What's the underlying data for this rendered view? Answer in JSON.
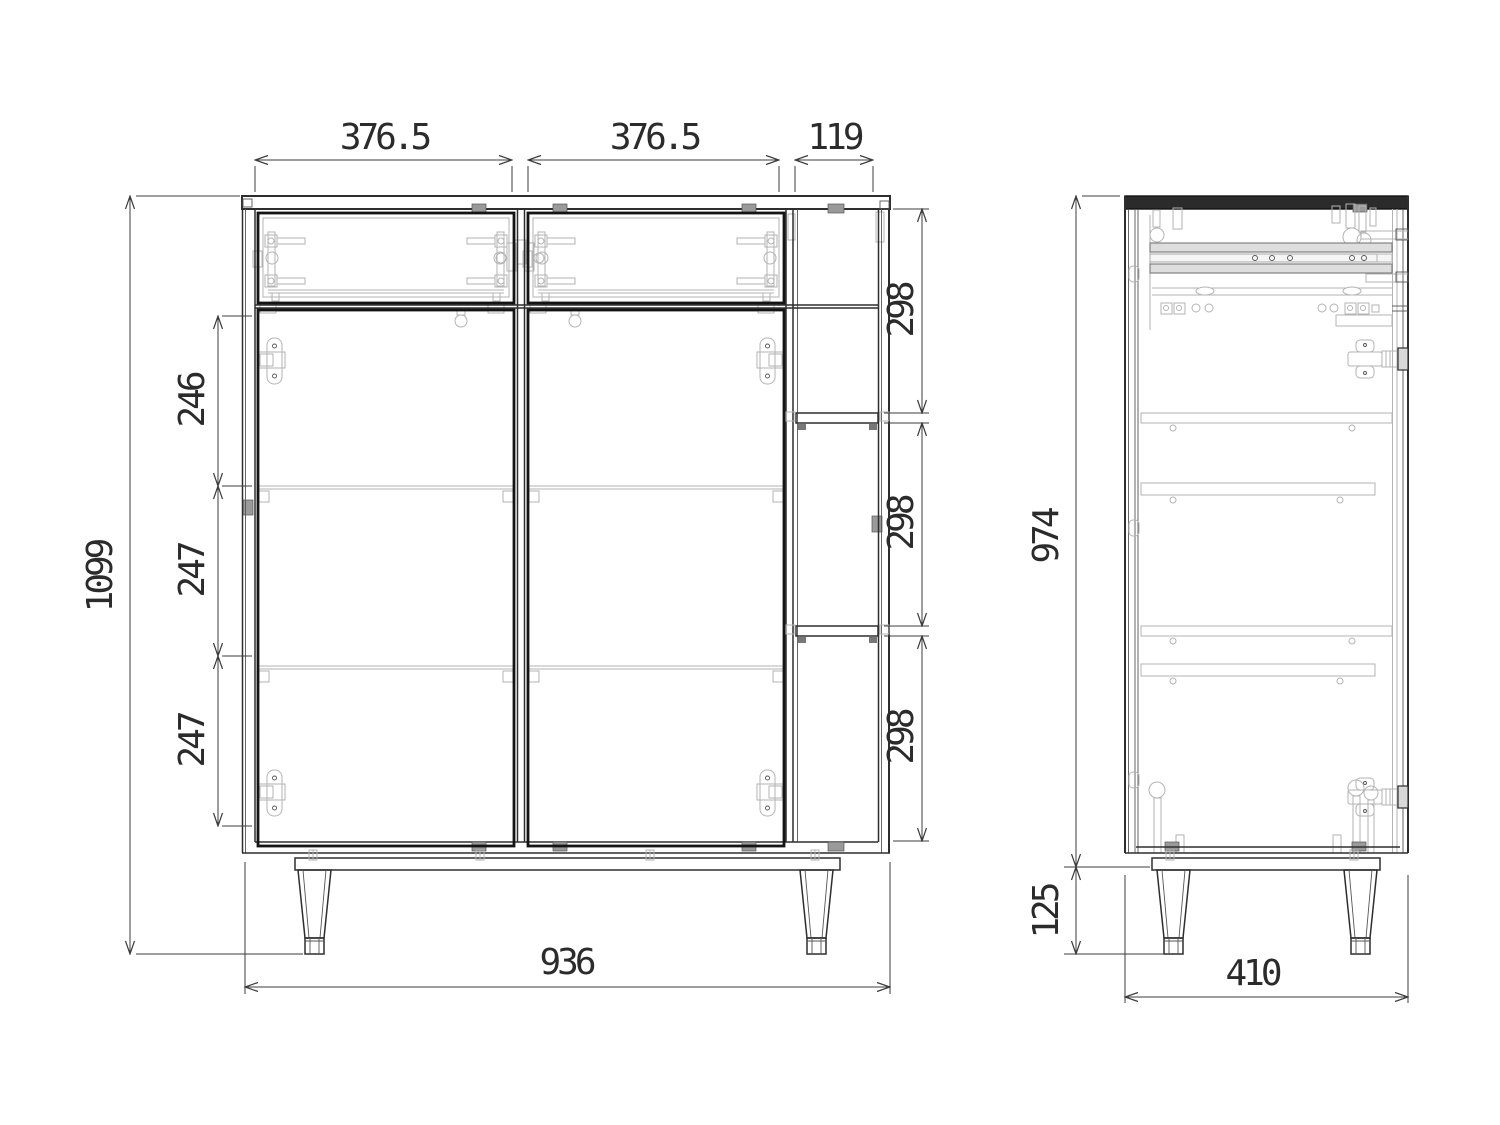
{
  "drawing": {
    "type": "furniture-cabinet-technical-drawing",
    "views": {
      "front_view_label": "front view",
      "side_view_label": "side view"
    },
    "front_view": {
      "dim_width_left_section": "376.5",
      "dim_width_right_section": "376.5",
      "dim_width_side_column": "119",
      "dim_height_overall": "1099",
      "dim_spacing_top": "246",
      "dim_spacing_middle": "247",
      "dim_spacing_bottom": "247",
      "dim_column_opening_top": "298",
      "dim_column_opening_middle": "298",
      "dim_column_opening_bottom": "298",
      "dim_width_overall": "936"
    },
    "side_view": {
      "dim_body_height": "974",
      "dim_leg_height": "125",
      "dim_depth_overall": "410"
    },
    "colors": {
      "background": "#ffffff",
      "line_heavy": "#141414",
      "line_medium": "#2e2e2e",
      "line_light": "#b3b3b3",
      "dimension_line": "#3c3c3c",
      "dimension_text": "#2b2b2b"
    }
  }
}
